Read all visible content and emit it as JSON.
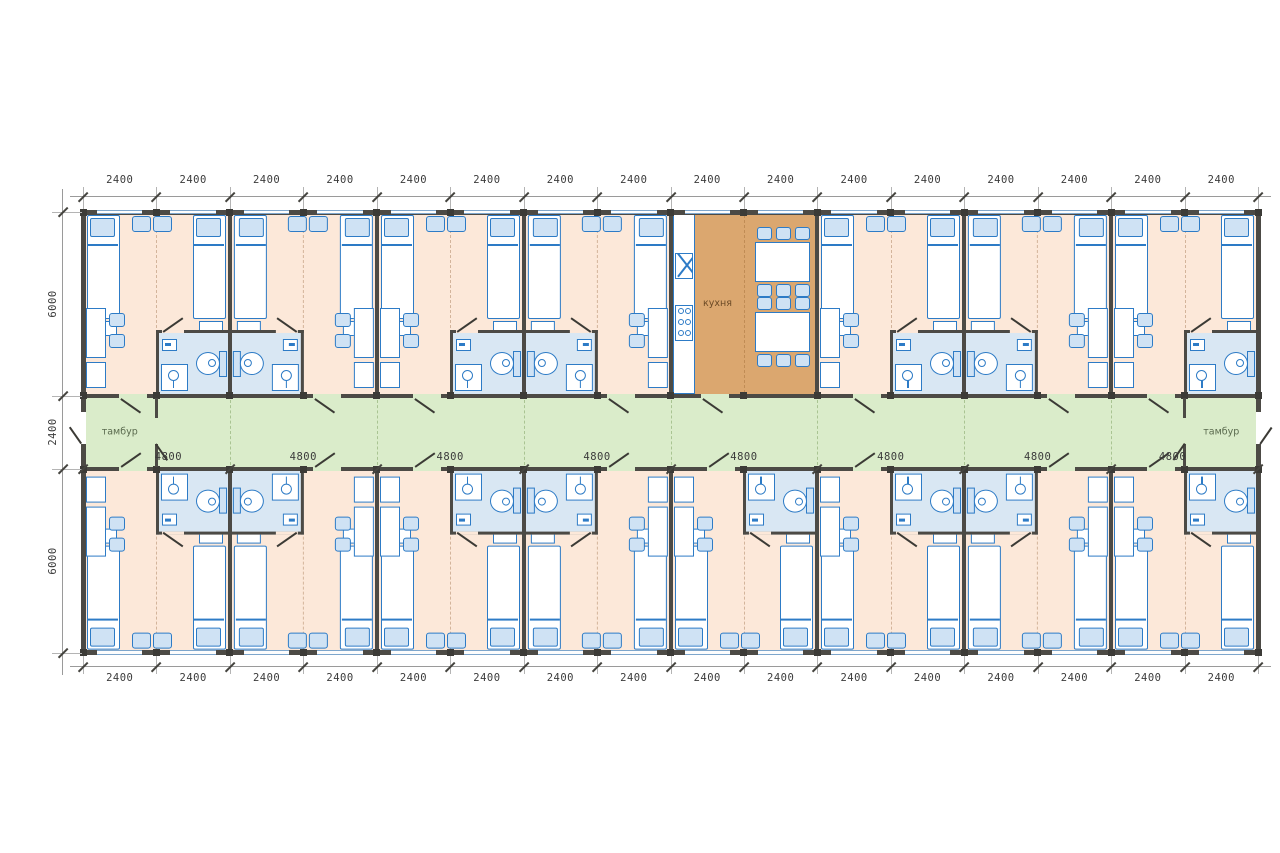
{
  "drawing": {
    "type": "architectural-floor-plan",
    "labels": {
      "vestibule_left": "тамбур",
      "vestibule_right": "тамбур",
      "kitchen": "кухня"
    },
    "dimensions": {
      "top": [
        "2400",
        "2400",
        "2400",
        "2400",
        "2400",
        "2400",
        "2400",
        "2400",
        "2400",
        "2400",
        "2400",
        "2400",
        "2400",
        "2400",
        "2400",
        "2400"
      ],
      "bottom": [
        "2400",
        "2400",
        "2400",
        "2400",
        "2400",
        "2400",
        "2400",
        "2400",
        "2400",
        "2400",
        "2400",
        "2400",
        "2400",
        "2400",
        "2400",
        "2400"
      ],
      "left": [
        "6000",
        "2400",
        "6000"
      ],
      "corridor": [
        "4800",
        "4800",
        "4800",
        "4800",
        "4800",
        "4800",
        "4800",
        "4800"
      ]
    },
    "layout": {
      "modules": 16,
      "module_width_mm": 2400,
      "unit_width_mm": 4800,
      "top_band_depth_mm": 6000,
      "corridor_depth_mm": 2400,
      "bottom_band_depth_mm": 6000
    },
    "top_units": [
      {
        "kind": "room",
        "bath": "right"
      },
      {
        "kind": "room",
        "bath": "left"
      },
      {
        "kind": "room",
        "bath": "right"
      },
      {
        "kind": "room",
        "bath": "left"
      },
      {
        "kind": "kitchen"
      },
      {
        "kind": "room",
        "bath": "right"
      },
      {
        "kind": "room",
        "bath": "left"
      },
      {
        "kind": "room",
        "bath": "right"
      }
    ],
    "bottom_units": [
      {
        "kind": "room",
        "bath": "right"
      },
      {
        "kind": "room",
        "bath": "left"
      },
      {
        "kind": "room",
        "bath": "right"
      },
      {
        "kind": "room",
        "bath": "left"
      },
      {
        "kind": "room",
        "bath": "right"
      },
      {
        "kind": "room",
        "bath": "right"
      },
      {
        "kind": "room",
        "bath": "left"
      },
      {
        "kind": "room",
        "bath": "right"
      }
    ],
    "colors": {
      "room_floor": "#fce8d9",
      "bathroom_floor": "#d9e7f3",
      "corridor_floor": "#daecca",
      "kitchen_floor": "#dba76f",
      "wall": "#4c4a45",
      "post": "#3c3b37",
      "furniture_stroke": "#2d7bc6",
      "furniture_fill_light": "#cfe2f4",
      "window_frame": "#7ea6cc",
      "dim_line": "#9a9a9a",
      "dim_tick": "#45443f",
      "dimension_text": "#3b3b3b",
      "vestibule_text": "#5a6a4e",
      "kitchen_text": "#6b4a26",
      "joint_dash_room": "#d3b49b",
      "joint_dash_corridor": "#a9c492",
      "joint_dash_kitchen": "#c08c55",
      "door_leaf": "#3b3a35"
    }
  }
}
